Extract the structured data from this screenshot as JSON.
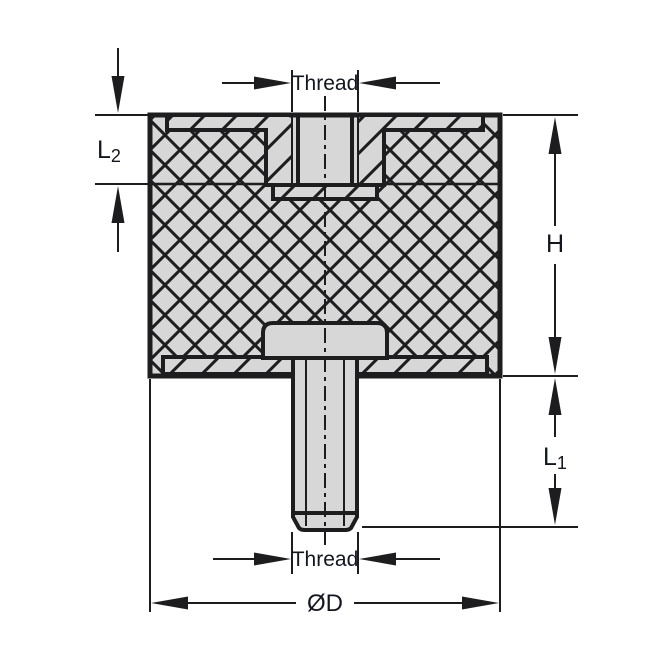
{
  "drawing": {
    "type": "technical-section-vibration-mount",
    "colors": {
      "line": "#1d1d1f",
      "part_fill": "#d7d7d7",
      "background": "#ffffff",
      "label_text": "#12161f"
    },
    "dimensions": {
      "thread_top": {
        "label": "Thread"
      },
      "insert_depth": {
        "label": "L",
        "subscript": "2"
      },
      "height": {
        "label": "H"
      },
      "stud_length": {
        "label": "L",
        "subscript": "1"
      },
      "thread_bottom": {
        "label": "Thread"
      },
      "diameter": {
        "label": "ØD"
      }
    }
  }
}
